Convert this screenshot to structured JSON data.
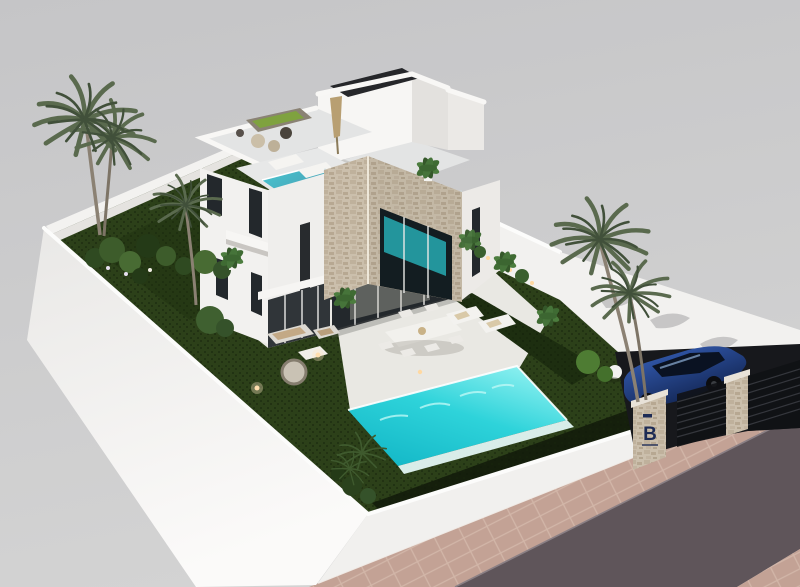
{
  "scene": {
    "type": "3d-architectural-render",
    "subject": "modern two-storey white villa with garden, swimming pool and carport",
    "view": "aerial isometric exterior",
    "elements": [
      "villa",
      "stair-bulkhead",
      "roof-terrace",
      "plunge-pool",
      "stone-clad-cube",
      "swimming-pool",
      "garden-lawn",
      "hedge",
      "perimeter-wall",
      "palm-trees",
      "sun-loungers",
      "outdoor-dining-set",
      "garden-lounge-set",
      "parasol",
      "carport",
      "blue-car",
      "entrance-pillars",
      "road",
      "sidewalk",
      "garden-lights"
    ]
  },
  "branding": {
    "monogram": "B"
  },
  "colors": {
    "sky_top": "#c5c5c7",
    "sky_bottom": "#d3d3d3",
    "wall_white": "#f2f1ef",
    "wall_shade": "#e2e0dd",
    "lawn": "#2c4019",
    "lawn_dark": "#1d2e10",
    "hedge": "#151f0c",
    "pool_light": "#8df0f0",
    "pool_mid": "#2ed3da",
    "pool_deep": "#12b6c6",
    "plunge_pool": "#4b9fb4",
    "paving": "#e9e8e3",
    "deck_gray": "#e3e4e4",
    "road": "#5f555a",
    "sidewalk": "#c3a295",
    "stone": "#cbbfac",
    "stone_dark": "#b2a48e",
    "glass": "#23282c",
    "car_blue": "#1f4da6",
    "car_dark": "#0e1e46",
    "brand_navy": "#1d2b55",
    "light_warm": "#ffd9a2",
    "palm_green": "#5a6a4e",
    "palm_dark": "#41503a",
    "shrub_green": "#3c5c2a",
    "umbrella_tan": "#b89f72"
  }
}
